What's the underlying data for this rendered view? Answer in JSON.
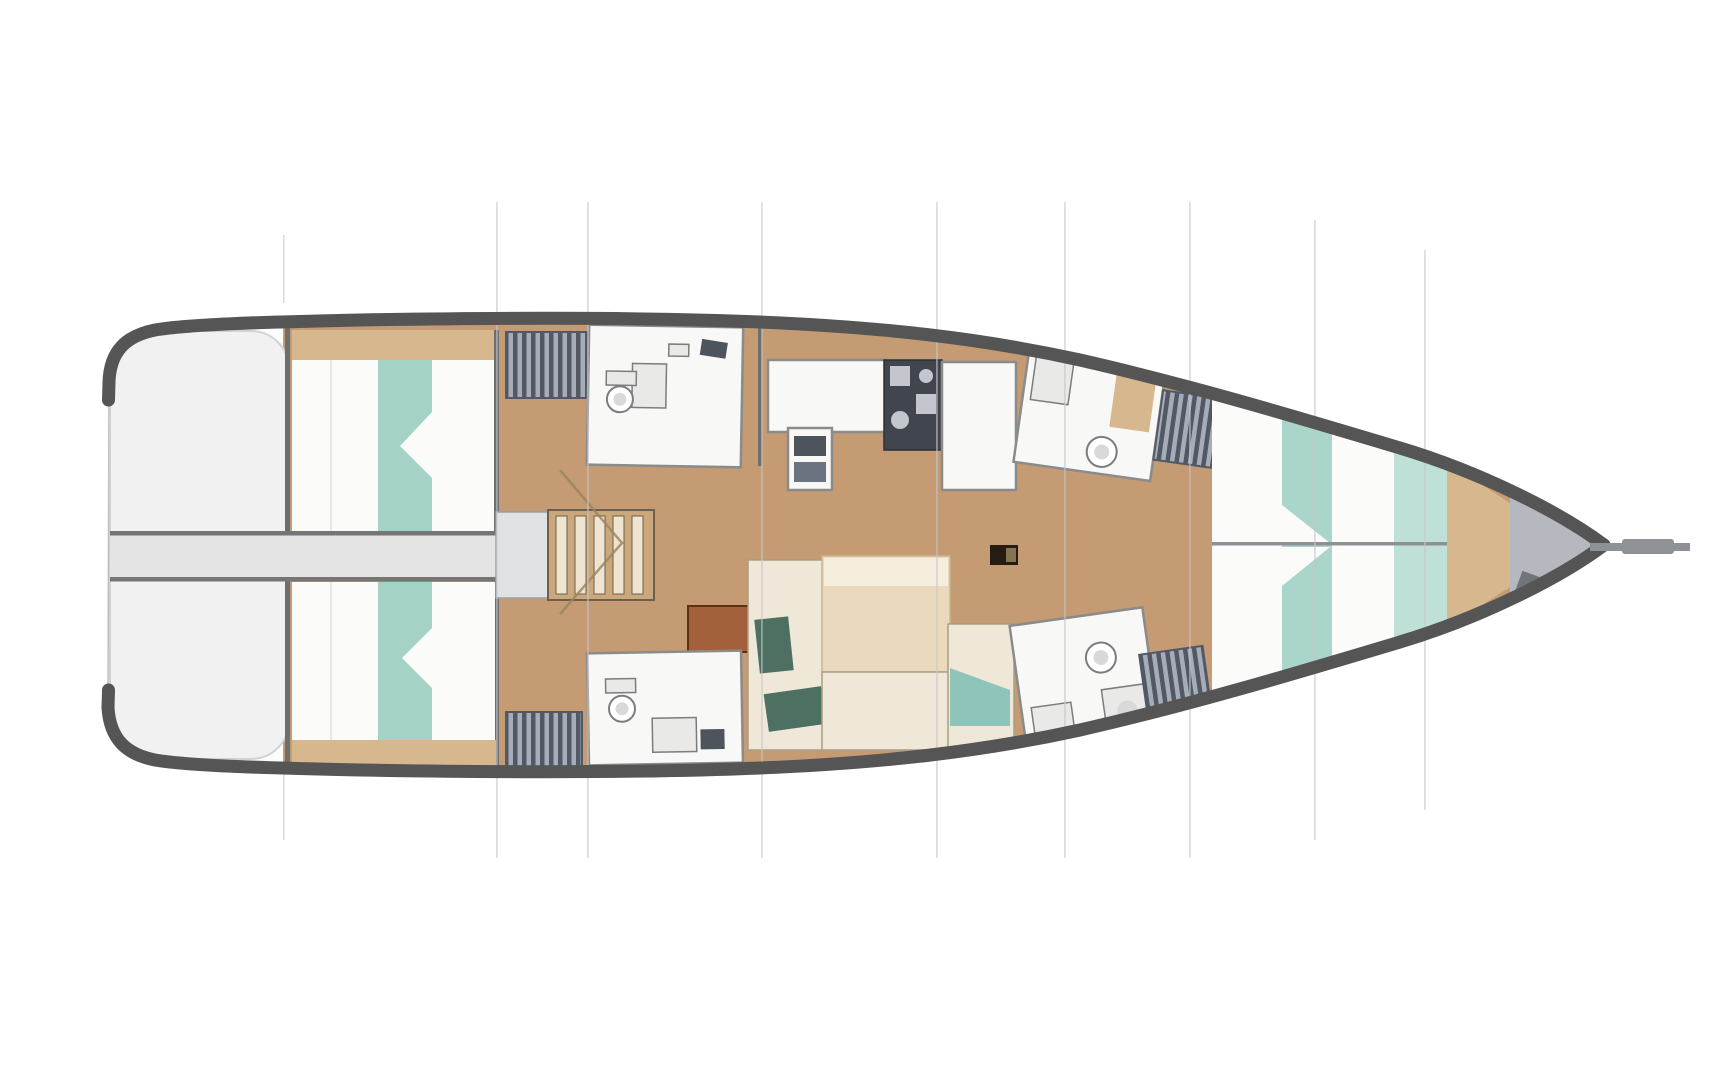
{
  "page": {
    "title": "Sailing yacht interior layout plan",
    "description": "Overhead deck-plan drawing of a sailing yacht interior, bow to the right, stern swim platform to the left, no text labels"
  },
  "diagram": {
    "type": "yacht-interior-floorplan",
    "view": "top-down",
    "bow_direction": "right",
    "stern_direction": "left",
    "features": [
      {
        "id": "swim-platform",
        "label": "stern swim platform"
      },
      {
        "id": "walkway",
        "label": "centerline walkway to transom"
      },
      {
        "id": "aft-cabin-port",
        "label": "aft double cabin (top) with teal-striped berth"
      },
      {
        "id": "aft-cabin-starboard",
        "label": "aft double cabin (bottom) with teal-striped berth"
      },
      {
        "id": "companionway-steps",
        "label": "companionway stairs"
      },
      {
        "id": "aft-head-port",
        "label": "aft bathroom with toilet and sink (top)"
      },
      {
        "id": "aft-head-starboard",
        "label": "aft bathroom with toilet and sink (bottom)"
      },
      {
        "id": "locker-hatched",
        "label": "four hatched storage lockers"
      },
      {
        "id": "galley",
        "label": "galley with stove, sink unit and counters"
      },
      {
        "id": "salon-table",
        "label": "salon dining table"
      },
      {
        "id": "salon-settee",
        "label": "salon settees with green and teal cushions"
      },
      {
        "id": "sideboard",
        "label": "rust-colored cabinet"
      },
      {
        "id": "mast-post",
        "label": "mast compression post"
      },
      {
        "id": "fwd-head-port",
        "label": "forward bathroom with shower seat and toilet (top)"
      },
      {
        "id": "fwd-head-starboard",
        "label": "forward bathroom with toilet and sink (bottom)"
      },
      {
        "id": "v-berth-cabin",
        "label": "forward owner cabin with mint-striped double berth"
      },
      {
        "id": "anchor-locker",
        "label": "bow anchor locker"
      },
      {
        "id": "bowsprit",
        "label": "bowsprit line extending from bow"
      },
      {
        "id": "station-lines",
        "label": "eight faint vertical station/bulkhead lines crossing the plan"
      }
    ],
    "counts": {
      "cabins": 3,
      "toilets": 4,
      "station_lines": 8
    }
  },
  "palette": {
    "bg": "#ffffff",
    "hull_band": "#555555",
    "hull_fill": "#fdfdfd",
    "hull_edge": "#bdbdbd",
    "platform": "#f1f1f1",
    "platform_edge": "#d2d2d2",
    "walkway": "#e4e4e4",
    "walkway_line": "#757575",
    "floor_wood": "#c49b72",
    "wood_light": "#d7b78e",
    "wall": "#6e6e6e",
    "berth_white": "#fbfbfa",
    "berth_teal": "#a5d2c7",
    "berth_mint": "#a9d5ca",
    "berth_mint_light": "#bfe0d6",
    "seam": "#8d9196",
    "room_fill": "#f8f8f6",
    "room_edge": "#8b8b8b",
    "hatch_dark": "#525965",
    "hatch_light": "#a7adb8",
    "steps_base": "#caa87c",
    "steps_tread": "#efe4cf",
    "steps_gap": "#6e5e4b",
    "stove_dark": "#41464e",
    "stove_light": "#c3c7cd",
    "appliance_dark": "#4e545c",
    "table_fill": "#ead9bc",
    "table_light": "#f5eedd",
    "settee_fill": "#efe8d9",
    "settee_edge": "#ab9d82",
    "cushion_green": "#4e7063",
    "cushion_teal": "#8ec4ba",
    "cabinet_rust": "#a2613b",
    "cabinet_rust_edge": "#5e3114",
    "mast_dark": "#251d13",
    "bow_gray": "#b5b9bf",
    "bowsprit": "#8e9297",
    "station_line": "#c5c7c9",
    "door_swing": "#97835f",
    "fixture_edge": "#7c7c7c",
    "fixture_fill": "#e9e9e7"
  }
}
